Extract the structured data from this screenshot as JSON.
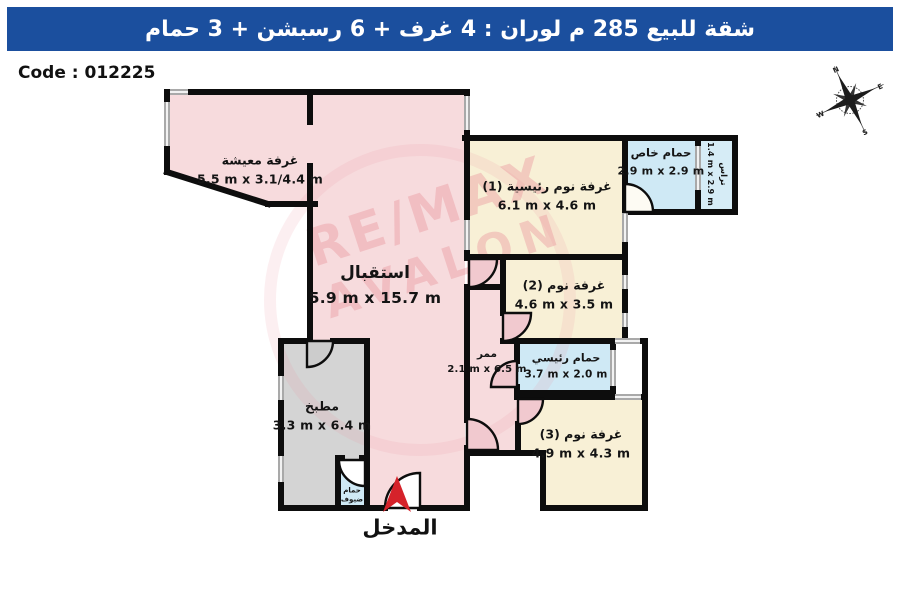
{
  "header": {
    "title": "شقة للبيع 285 م لوران :  4 غرف + 6 رسبشن + 3 حمام"
  },
  "code": {
    "label": "Code : 012225"
  },
  "compass": {
    "north": "N",
    "east": "E",
    "south": "S",
    "west": "W"
  },
  "watermark": {
    "line1": "RE/MAX",
    "line2": "AVALON"
  },
  "entrance": {
    "label": "المدخل"
  },
  "rooms": [
    {
      "id": "living-room",
      "name": "غرفة معيشة",
      "dims": "5.5 m x 3.1/4.4 m"
    },
    {
      "id": "reception",
      "name": "استقبال",
      "dims": "5.9 m x 15.7 m"
    },
    {
      "id": "master-bedroom",
      "name": "غرفة نوم رئيسية (1)",
      "dims": "6.1 m x 4.6 m"
    },
    {
      "id": "private-bath",
      "name": "حمام خاص",
      "dims": "2.9 m x 2.9 m"
    },
    {
      "id": "terrace",
      "name": "تراس",
      "dims": "1.4 m x 2.9 m"
    },
    {
      "id": "bedroom-2",
      "name": "غرفة نوم (2)",
      "dims": "4.6 m x 3.5 m"
    },
    {
      "id": "main-bath",
      "name": "حمام رئيسي",
      "dims": "3.7 m x 2.0 m"
    },
    {
      "id": "bedroom-3",
      "name": "غرفة نوم (3)",
      "dims": "4.9 m x 4.3 m"
    },
    {
      "id": "corridor",
      "name": "ممر",
      "dims": "2.1 m x 6.5 m"
    },
    {
      "id": "kitchen",
      "name": "مطبخ",
      "dims": "3.3 m x 6.4 m"
    },
    {
      "id": "guest-bath",
      "name": "حمام ضيوف"
    }
  ],
  "colors": {
    "header-bg": "#1b4f9e",
    "header-text": "#ffffff",
    "wall": "#0d0d0d",
    "room-pink": "#f7dbdd",
    "room-pink-dark": "#f1c9cf",
    "room-cream": "#f8f0d6",
    "room-blue": "#cfe9f5",
    "room-gray": "#d4d4d4",
    "window-gray": "#a9a9a9",
    "arrow-red": "#d5222a"
  }
}
